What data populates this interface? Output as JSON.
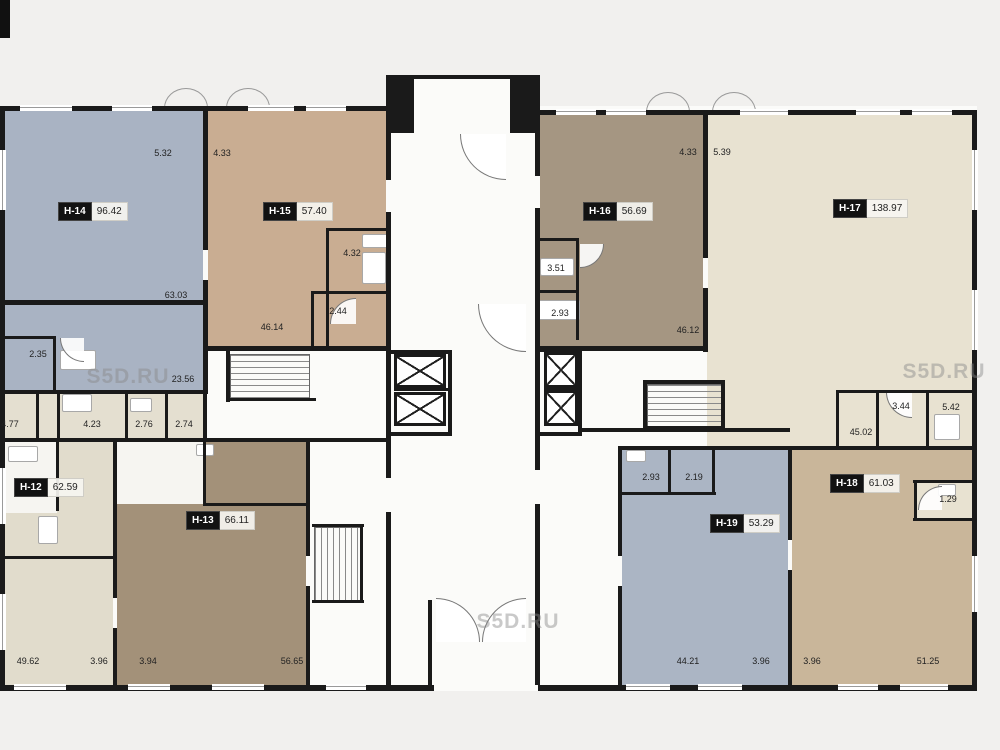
{
  "plan_title": "Floor plan",
  "watermark": {
    "text": "S5D.RU"
  },
  "units": [
    {
      "id": "H-14",
      "area": "96.42"
    },
    {
      "id": "H-15",
      "area": "57.40"
    },
    {
      "id": "H-16",
      "area": "56.69"
    },
    {
      "id": "H-17",
      "area": "138.97"
    },
    {
      "id": "H-12",
      "area": "62.59"
    },
    {
      "id": "H-13",
      "area": "66.11"
    },
    {
      "id": "H-18",
      "area": "61.03"
    },
    {
      "id": "H-19",
      "area": "53.29"
    }
  ],
  "dims": [
    {
      "v": "5.32"
    },
    {
      "v": "4.33"
    },
    {
      "v": "63.03"
    },
    {
      "v": "46.14"
    },
    {
      "v": "2.44"
    },
    {
      "v": "4.32"
    },
    {
      "v": "2.35"
    },
    {
      "v": "23.56"
    },
    {
      "v": "4.77"
    },
    {
      "v": "4.23"
    },
    {
      "v": "2.76"
    },
    {
      "v": "2.74"
    },
    {
      "v": "3.51"
    },
    {
      "v": "2.93"
    },
    {
      "v": "46.12"
    },
    {
      "v": "4.33"
    },
    {
      "v": "5.39"
    },
    {
      "v": "3.44"
    },
    {
      "v": "5.42"
    },
    {
      "v": "45.02"
    },
    {
      "v": "2.93"
    },
    {
      "v": "2.19"
    },
    {
      "v": "1.29"
    },
    {
      "v": "49.62"
    },
    {
      "v": "3.96"
    },
    {
      "v": "3.94"
    },
    {
      "v": "56.65"
    },
    {
      "v": "44.21"
    },
    {
      "v": "3.96"
    },
    {
      "v": "3.96"
    },
    {
      "v": "51.25"
    }
  ],
  "colors": {
    "wall": "#1a1a1a",
    "plan_bg": "#fbfbf9",
    "outer_bg": "#f1f0ee",
    "h14": "#a9b3c3",
    "h15": "#c9ad92",
    "h16": "#a59682",
    "h17": "#e8e2d1",
    "h12": "#e1dccc",
    "h13": "#a39179",
    "h18": "#c9b69a",
    "h19": "#abb5c4",
    "band": "#e4dfd0",
    "roomWhite": "#f6f5f1"
  }
}
